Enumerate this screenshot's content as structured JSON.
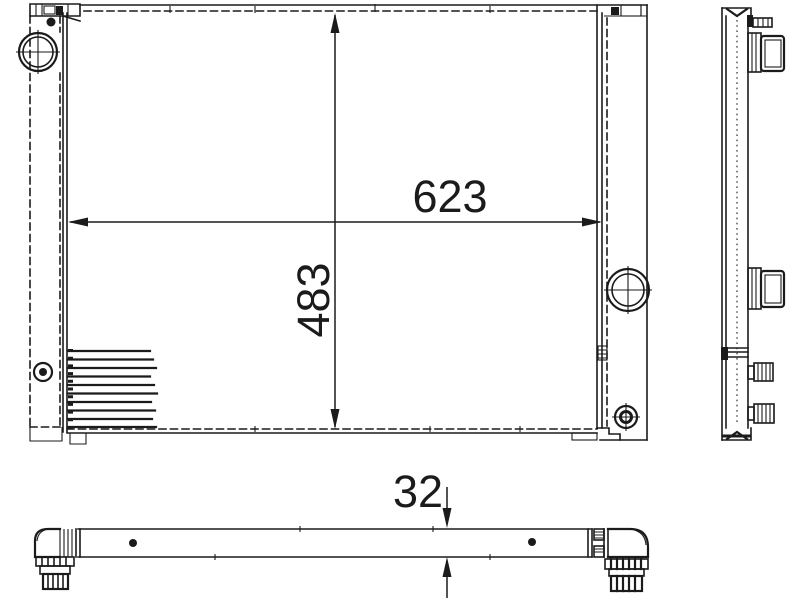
{
  "drawing": {
    "colors": {
      "background": "#ffffff",
      "line": "#1b1b1b"
    },
    "dimensions": {
      "core_width_mm": "623",
      "core_height_mm": "483",
      "thickness_mm": "32"
    }
  }
}
